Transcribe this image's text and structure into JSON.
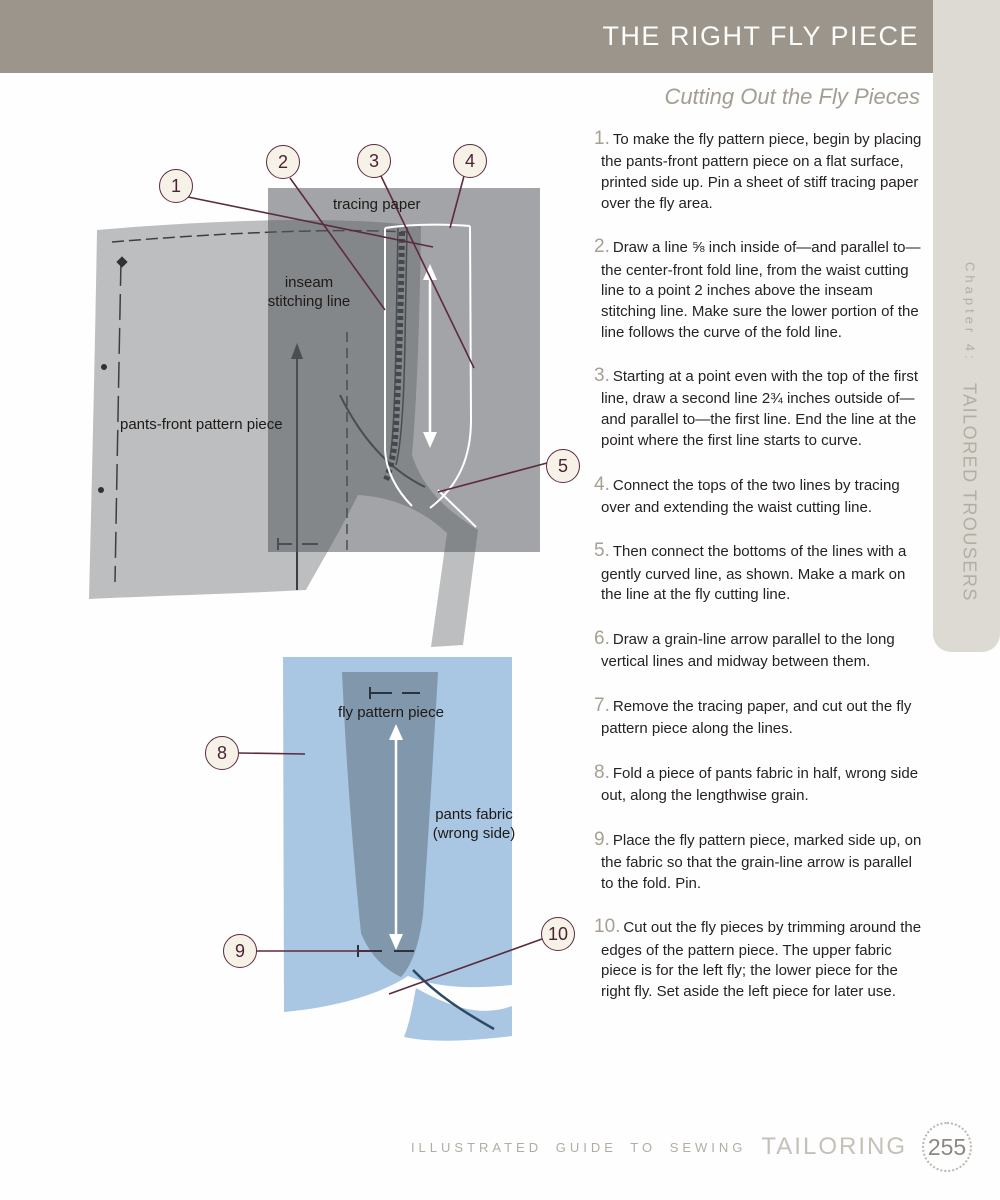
{
  "header": {
    "title": "THE RIGHT FLY PIECE",
    "subtitle": "Cutting Out the Fly Pieces"
  },
  "sidebar": {
    "chapter_label": "Chapter 4:",
    "chapter_title": "TAILORED TROUSERS"
  },
  "steps": [
    {
      "num": "1.",
      "text": "To make the fly pattern piece, begin by placing the pants-front pattern piece on a flat surface, printed side up. Pin a sheet of stiff tracing paper over the fly area."
    },
    {
      "num": "2.",
      "text": "Draw a line ⅝ inch inside of—and parallel to—the center-front fold line, from the waist cutting line to a point 2 inches above the inseam stitching line. Make sure the lower portion of the line follows the curve of the fold line."
    },
    {
      "num": "3.",
      "text": "Starting at a point even with the top of the first line, draw a second line 2¾ inches outside of—and parallel to—the first line. End the line at the point where the first line starts to curve."
    },
    {
      "num": "4.",
      "text": "Connect the tops of the two lines by tracing over and extending the waist cutting line."
    },
    {
      "num": "5.",
      "text": "Then connect the bottoms of the lines with a gently curved line, as shown. Make a mark on the line at the fly cutting line."
    },
    {
      "num": "6.",
      "text": "Draw a grain-line arrow parallel to the long vertical lines and midway between them."
    },
    {
      "num": "7.",
      "text": "Remove the tracing paper, and cut out the fly pattern piece along the lines."
    },
    {
      "num": "8.",
      "text": "Fold a piece of pants fabric in half, wrong side out, along the lengthwise grain."
    },
    {
      "num": "9.",
      "text": "Place the fly pattern piece, marked side up, on the fabric so that the grain-line arrow is parallel to the fold. Pin."
    },
    {
      "num": "10.",
      "text": "Cut out the fly pieces by trimming around the edges of the pattern piece. The upper fabric piece is for the left fly; the lower piece for the right fly. Set aside the left piece for later use."
    }
  ],
  "diagram_top": {
    "labels": {
      "tracing_paper": "tracing paper",
      "inseam_line1": "inseam",
      "inseam_line2": "stitching line",
      "pattern_piece": "pants-front pattern piece"
    },
    "callouts": [
      "1",
      "2",
      "3",
      "4",
      "5"
    ]
  },
  "diagram_bottom": {
    "labels": {
      "fly_piece": "fly pattern piece",
      "fabric_line1": "pants fabric",
      "fabric_line2": "(wrong side)"
    },
    "callouts": [
      "8",
      "9",
      "10"
    ]
  },
  "footer": {
    "series": "ILLUSTRATED GUIDE TO SEWING",
    "book": "TAILORING",
    "page_number": "255"
  },
  "colors": {
    "header_band": "#9b958b",
    "sidebar_tab": "#dddad3",
    "accent_maroon": "#5c2b3d",
    "callout_fill": "#f7f2e8",
    "pattern_gray": "#bdbebf",
    "tracing_overlay": "rgba(86,90,94,0.55)",
    "fabric_blue": "#a9c6e2",
    "fly_piece_blue": "#8197ab",
    "step_number": "#a79f93"
  }
}
